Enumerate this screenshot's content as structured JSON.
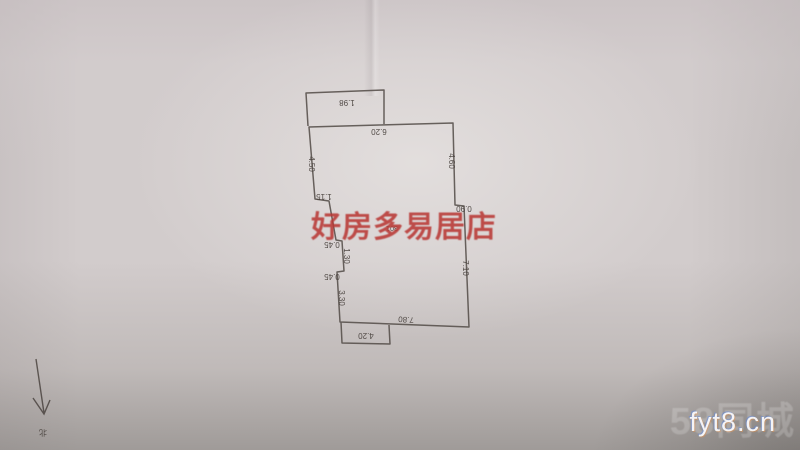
{
  "photo": {
    "agency_watermark": {
      "text": "好房多易居店",
      "color": "#b83834"
    },
    "site_watermark": {
      "text": "fyt8.cn"
    },
    "background_watermark": {
      "text": "58同城"
    },
    "north_indicator": {
      "label": "北"
    }
  },
  "floorplan": {
    "room_number": "301",
    "line_color": "#564f4a",
    "orientation_note": "drawing photographed upside down - all figures rotated 180",
    "dimensions": {
      "top_balcony_width": "1.98",
      "top_wall": "6.20",
      "left_wall_upper": "4.50",
      "right_wall_upper": "4.60",
      "left_step": "1.15",
      "left_jog_upper": "0.45",
      "left_wall_middle": "1.30",
      "left_jog_lower": "0.45",
      "left_wall_lower": "3.30",
      "right_step": "0.90",
      "right_wall_lower": "7.10",
      "bottom_wall": "7.80",
      "bottom_balcony_width": "4.20"
    }
  }
}
